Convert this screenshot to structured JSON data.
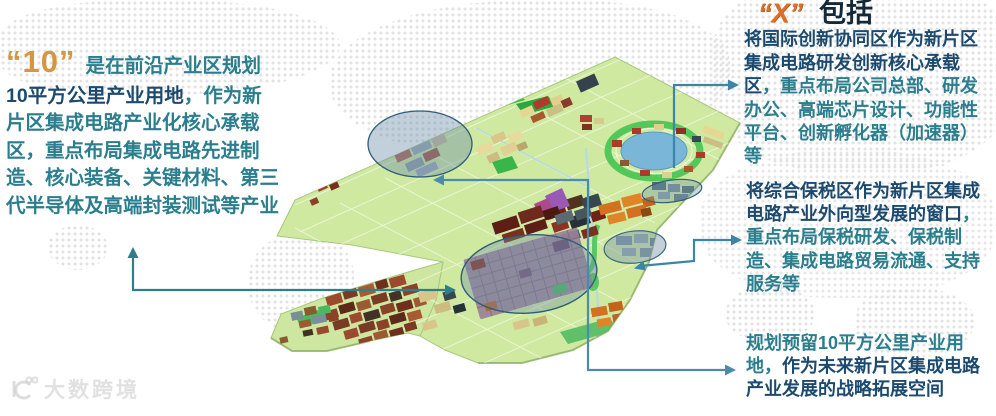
{
  "colors": {
    "teal_text": "#2a7e8d",
    "navy_text": "#1c4a6e",
    "title_dark": "#13293a",
    "orange_number": "#d6953f",
    "x_orange": "#dd6f26",
    "arrow": "#3b86a3",
    "map_base_green": "#cfe9a0",
    "lake_blue": "#79b6d8",
    "highlight_ellipse": "#2f5d78"
  },
  "left_block": {
    "quote_number": "“10”",
    "intro": "是在前沿产业区规划",
    "bold_blue": "10平方公里产业用地",
    "rest_after_bold": "，作为新片区集成电路产业化核心承载区，重点布局集成电路先进制造、核心装备、关键材料、第三代半导体及高端封装测试等产业"
  },
  "right_top_block": {
    "quote_letter": "“X”",
    "title": "包括",
    "bold_lead": "将国际创新协同区作为新片区集成电路研发创新核心承载区",
    "rest": "，重点布局公司总部、研发办公、高端芯片设计、功能性平台、创新孵化器（加速器）等"
  },
  "right_middle_block": {
    "bold_lead": "将综合保税区作为新片区集成电路产业外向型发展的窗口",
    "rest": "，重点布局保税研发、保税制造、集成电路贸易流通、支持服务等"
  },
  "right_bottom_block": {
    "lead": "规划预留10平方公里产业用地，",
    "bold_rest": "作为未来新片区集成电路产业发展的战略拓展空间"
  },
  "watermark": {
    "text": "大数跨境"
  }
}
